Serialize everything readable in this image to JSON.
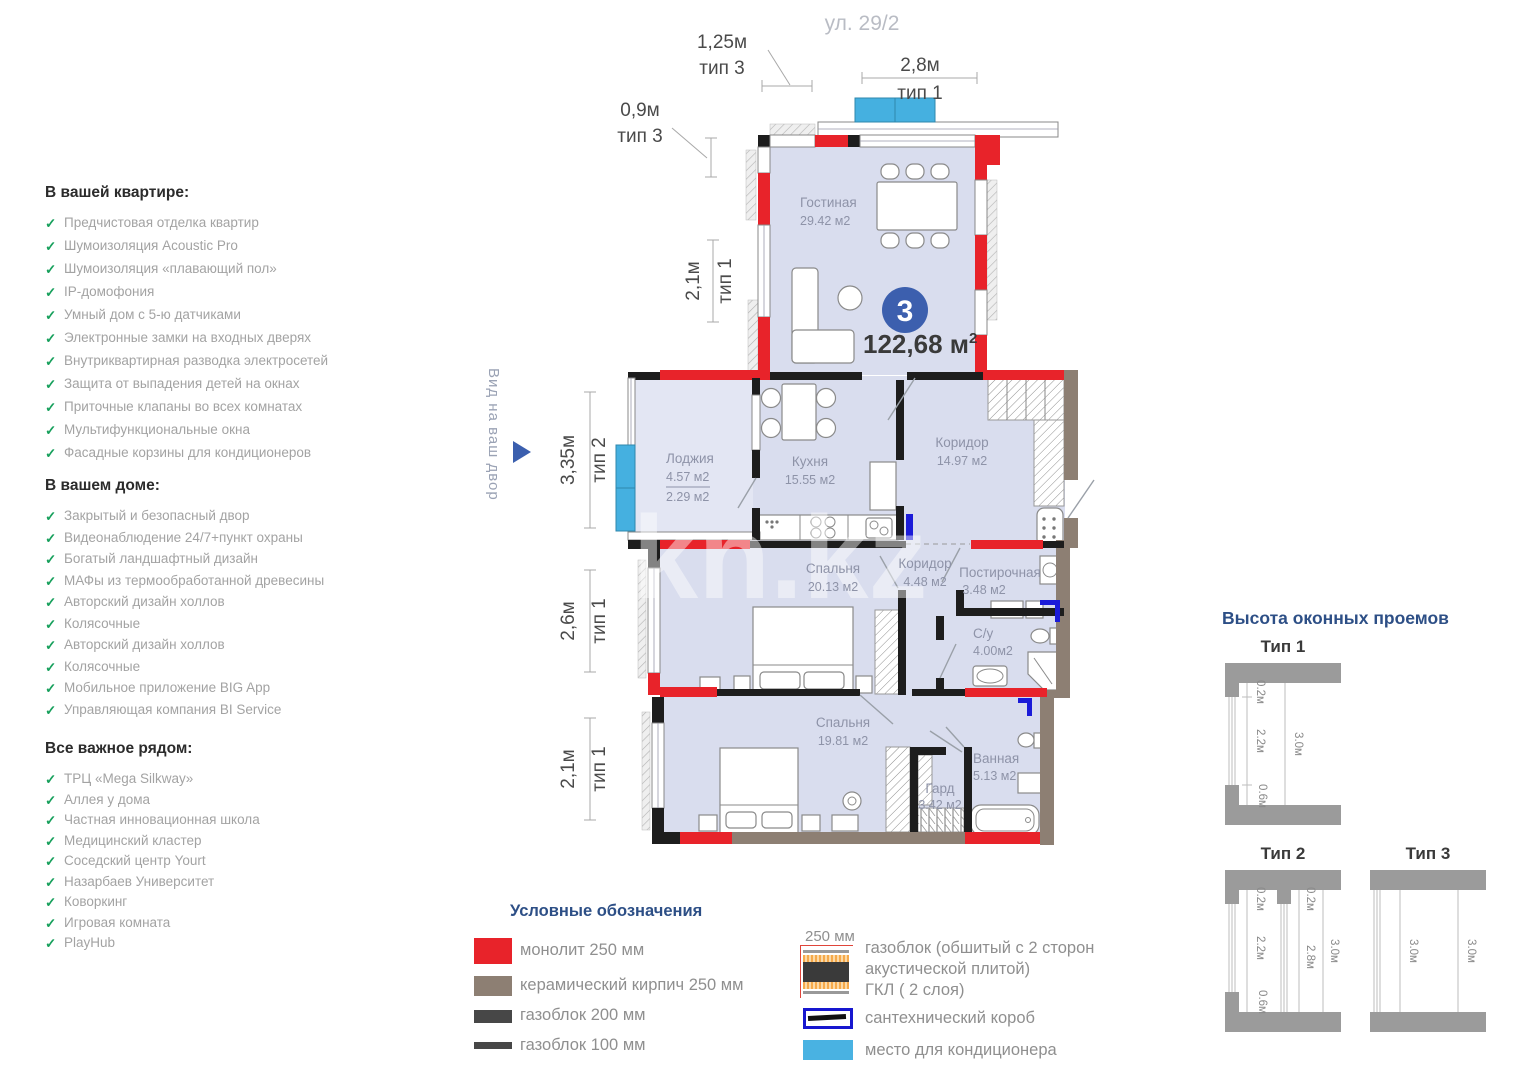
{
  "lists": [
    {
      "heading": "В вашей квартире:",
      "items": [
        "Предчистовая отделка квартир",
        "Шумоизоляция Acoustic Pro",
        "Шумоизоляция «плавающий пол»",
        "IP-домофония",
        "Умный дом с 5-ю датчиками",
        "Электронные замки на входных дверях",
        "Внутриквартирная разводка электросетей",
        "Защита от выпадения детей на окнах",
        "Приточные клапаны во всех комнатах",
        "Мультифункциональные окна",
        "Фасадные корзины для кондиционеров"
      ]
    },
    {
      "heading": "В вашем доме:",
      "items": [
        "Закрытый и безопасный двор",
        "Видеонаблюдение 24/7+пункт охраны",
        "Богатый ландшафтный дизайн",
        "МАФы из термообработанной древесины",
        "Авторский дизайн холлов",
        "Колясочные",
        "Авторский дизайн холлов",
        "Колясочные",
        "Мобильное приложение BIG App",
        "Управляющая компания BI Service"
      ]
    },
    {
      "heading": "Все важное рядом:",
      "items": [
        "ТРЦ «Mega Silkway»",
        "Аллея у дома",
        "Частная инновационная школа",
        "Медицинский кластер",
        "Соседский центр Yourt",
        "Назарбаев Университет",
        "Коворкинг",
        "Игровая комната",
        "PlayHub"
      ]
    }
  ],
  "plan": {
    "street": "ул. 29/2",
    "view": "Вид на ваш двор",
    "watermark": "kn.kz",
    "badge": {
      "number": "3",
      "area_main": "122,68 м",
      "area_sup": "2"
    },
    "rooms": {
      "living": {
        "name": "Гостиная",
        "area": "29.42 м2"
      },
      "loggia": {
        "name": "Лоджия",
        "area1": "4.57 м2",
        "area2": "2.29 м2"
      },
      "kitchen": {
        "name": "Кухня",
        "area": "15.55 м2"
      },
      "hall": {
        "name": "Коридор",
        "area": "14.97 м2"
      },
      "bedroom1": {
        "name": "Спальня",
        "area": "20.13 м2"
      },
      "hall2": {
        "name": "Коридор",
        "area": "4.48 м2"
      },
      "laundry": {
        "name": "Постирочная",
        "area": "3.48 м2"
      },
      "wc": {
        "name": "С/у",
        "area": "4.00м2"
      },
      "bedroom2": {
        "name": "Спальня",
        "area": "19.81 м2"
      },
      "wardrobe": {
        "name": "Гард",
        "area": "3.42 м2"
      },
      "bath": {
        "name": "Ванная",
        "area": "5.13 м2"
      }
    },
    "dims": {
      "lodge": {
        "v": "1,25м",
        "t": "тип 3"
      },
      "small": {
        "v": "0,9м",
        "t": "тип 3"
      },
      "ac": {
        "v": "2,8м",
        "t": "тип 1"
      },
      "living": {
        "v": "2,1м",
        "t": "тип 1"
      },
      "loggia": {
        "v": "3,35м",
        "t": "тип 2"
      },
      "bedroom1": {
        "v": "2,6м",
        "t": "тип 1"
      },
      "bedroom2": {
        "v": "2,1м",
        "t": "тип 1"
      }
    }
  },
  "win": {
    "heading": "Высота оконных проемов",
    "t1": {
      "label": "Тип 1",
      "m1": "0.2м",
      "m2": "2.2м",
      "m3": "0.6м",
      "total": "3.0м"
    },
    "t2": {
      "label": "Тип 2",
      "m1": "0.2м",
      "m2": "2.2м",
      "m3": "0.6м",
      "m4": "0.2м",
      "m5": "2.8м",
      "total": "3.0м"
    },
    "t3": {
      "label": "Тип 3",
      "m1": "3.0м",
      "total": "3.0м"
    }
  },
  "legend": {
    "heading": "Условные обозначения",
    "monolith": "монолит 250 мм",
    "brick": "керамический кирпич 250 мм",
    "gas200": "газоблок 200 мм",
    "gas100": "газоблок 100 мм",
    "note_size": "250 мм",
    "note_l1": "газоблок (обшитый с 2 сторон",
    "note_l2": "акустической плитой)",
    "note_l3": "ГКЛ ( 2 слоя)",
    "sanitary": "сантехнический короб",
    "ac": "место для кондиционера"
  },
  "colors": {
    "monolith_red": "#e8232a",
    "brick_brown": "#8d7f73",
    "gasblock_dark": "#3a3a3a",
    "ac_blue": "#45b0e0",
    "sanitary_blue": "#1717cf",
    "badge_blue": "#3c5fae",
    "heading_blue": "#2d4f86",
    "check_green": "#17a05c",
    "floor": "#d9ddee"
  }
}
